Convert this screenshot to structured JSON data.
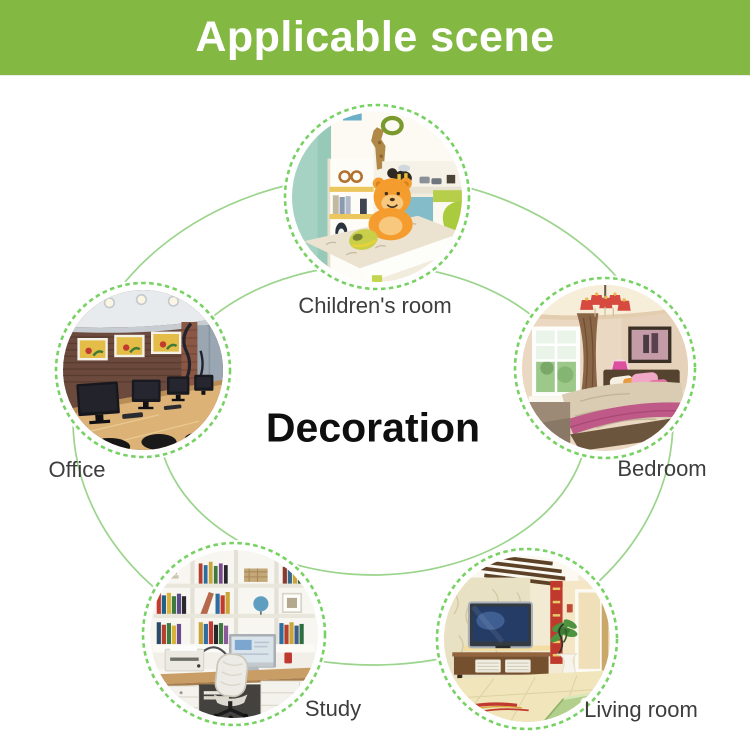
{
  "header": {
    "title": "Applicable scene"
  },
  "center_title": "Decoration",
  "colors": {
    "header_bg": "#83b843",
    "header_text": "#ffffff",
    "connector_line": "#9bd48c",
    "dashed_ring": "#77d163",
    "label_text": "#3d3d3d",
    "center_title_color": "#0f0f0f"
  },
  "scenes": [
    {
      "name": "children-room",
      "label": "Children's room"
    },
    {
      "name": "office",
      "label": "Office"
    },
    {
      "name": "bedroom",
      "label": "Bedroom"
    },
    {
      "name": "study",
      "label": "Study"
    },
    {
      "name": "living-room",
      "label": "Living room"
    }
  ]
}
